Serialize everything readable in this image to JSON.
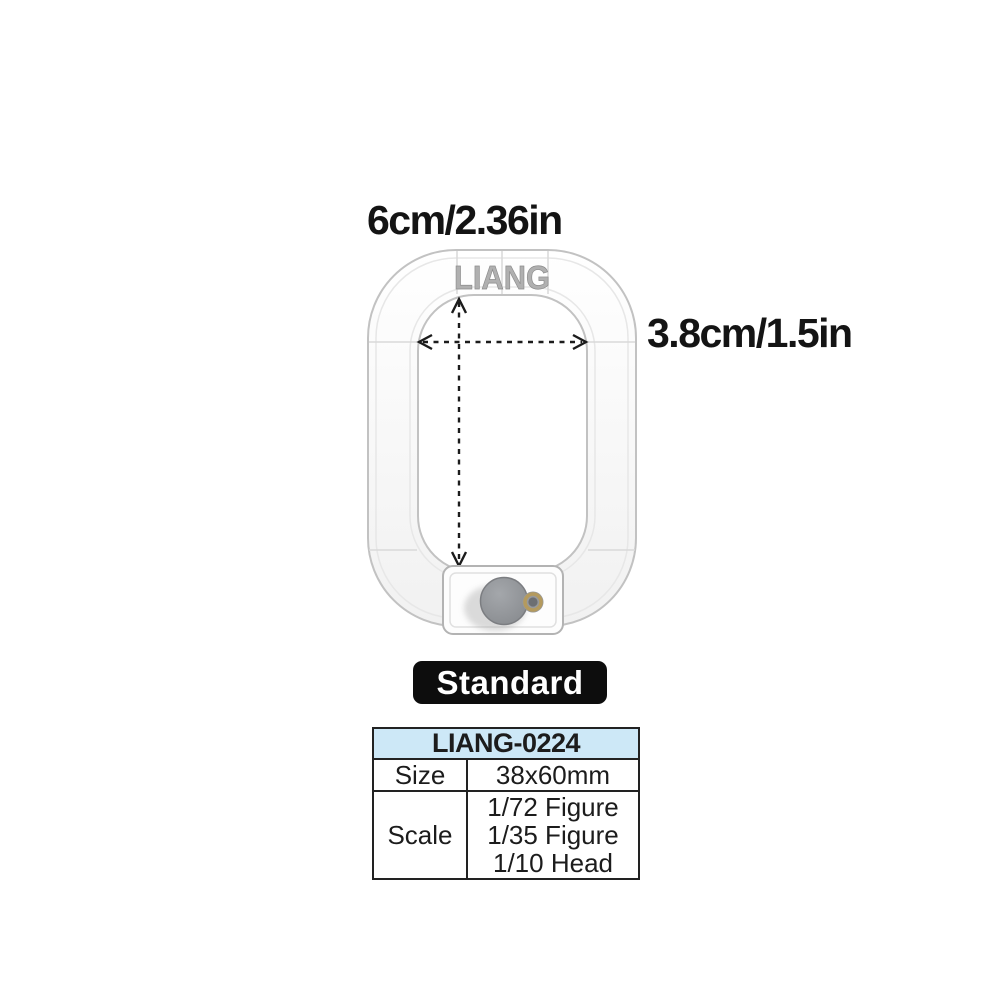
{
  "annotations": {
    "width_label": "6cm/2.36in",
    "height_label": "3.8cm/1.5in"
  },
  "product": {
    "logo": "LIANG",
    "variant": "Standard"
  },
  "spec_table": {
    "header": "LIANG-0224",
    "rows": [
      {
        "label": "Size",
        "values": [
          "38x60mm"
        ]
      },
      {
        "label": "Scale",
        "values": [
          "1/72 Figure",
          "1/35 Figure",
          "1/10 Head"
        ]
      }
    ]
  },
  "colors": {
    "background": "#ffffff",
    "dimension_text": "#141414",
    "frame_outline": "#c2c2c2",
    "frame_highlight": "#e7e7e7",
    "logo_gray": "#b0b0b0",
    "arrow_black": "#1c1c1c",
    "knob_gray": "#8f9296",
    "brass": "#b49a5e",
    "badge_bg": "#0d0d0d",
    "badge_text": "#ffffff",
    "table_header_bg": "#cde8f7",
    "table_border": "#222222"
  }
}
